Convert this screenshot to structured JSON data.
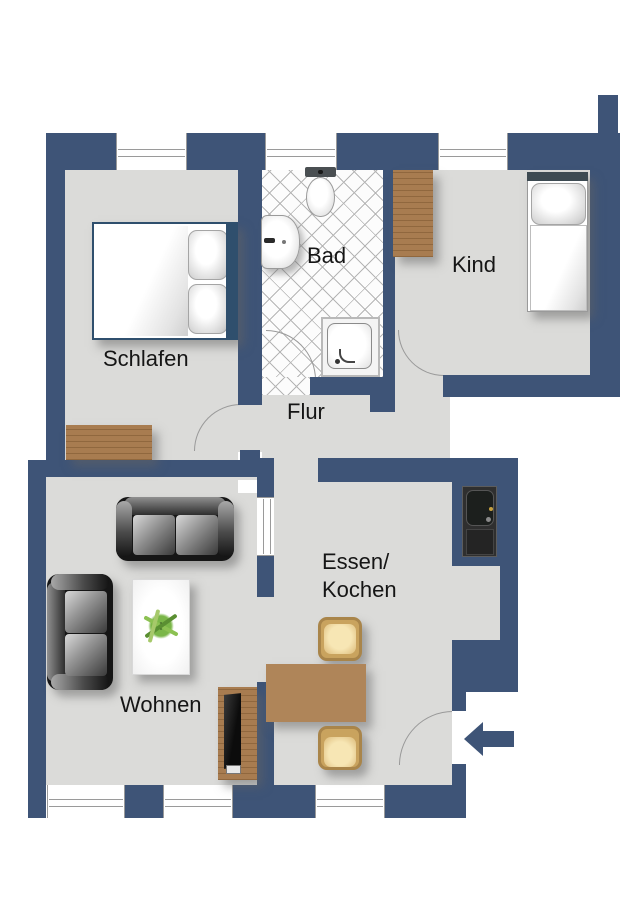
{
  "plan": {
    "rooms": [
      {
        "id": "schlafen",
        "label": "Schlafen"
      },
      {
        "id": "bad",
        "label": "Bad"
      },
      {
        "id": "kind",
        "label": "Kind"
      },
      {
        "id": "flur",
        "label": "Flur"
      },
      {
        "id": "essen_kochen",
        "label_line1": "Essen/",
        "label_line2": "Kochen"
      },
      {
        "id": "wohnen",
        "label": "Wohnen"
      }
    ],
    "icons": {
      "entrance_arrow": "left-arrow"
    },
    "colors": {
      "wall": "#3E5477",
      "floor": "#DBDBD9",
      "wood": "#A87C50",
      "tile_line": "#B5B5B5",
      "outside": "#FFFFFF"
    }
  }
}
